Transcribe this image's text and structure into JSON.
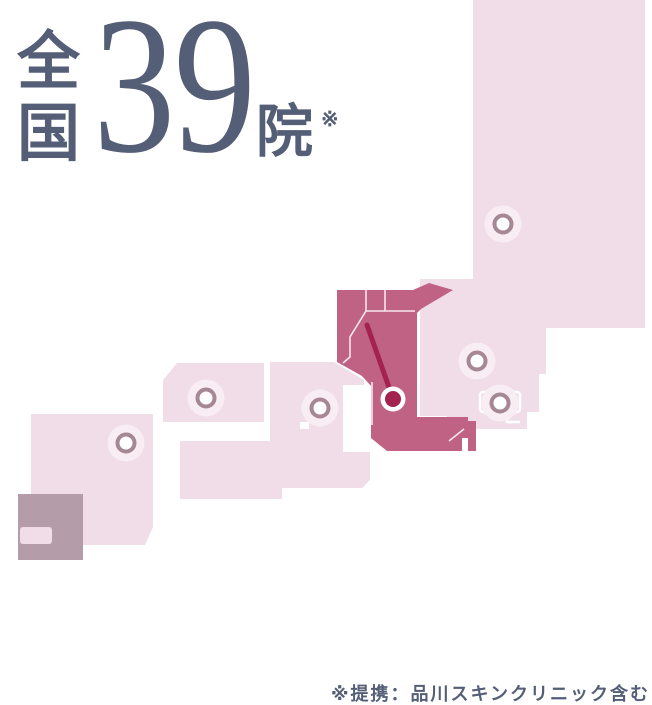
{
  "title": {
    "region_word": "全国",
    "count": "39",
    "unit": "院",
    "asterisk": "※"
  },
  "footnote": "※提携：品川スキンクリニック含む",
  "colors": {
    "ink": "#555e77",
    "pink": "#f1dde7",
    "halo": "#f8edf3",
    "ring": "#a68794",
    "magenta": "#c06284",
    "crimson": "#a3224f",
    "gray": "#b59ca9"
  },
  "map": {
    "regions": [
      {
        "id": "hokkaido",
        "highlighted": false
      },
      {
        "id": "tohoku",
        "highlighted": false
      },
      {
        "id": "kanto-koshinetsu",
        "highlighted": true
      },
      {
        "id": "chubu-kinki",
        "highlighted": false
      },
      {
        "id": "chugoku",
        "highlighted": false
      },
      {
        "id": "shikoku",
        "highlighted": false
      },
      {
        "id": "kyushu",
        "highlighted": false
      },
      {
        "id": "okinawa",
        "highlighted": false
      }
    ],
    "markers": [
      {
        "region": "hokkaido",
        "type": "clinic-dot",
        "x": 503,
        "y": 224
      },
      {
        "region": "tohoku-north",
        "type": "clinic-dot",
        "x": 477,
        "y": 361
      },
      {
        "region": "tohoku-south",
        "type": "clinic-dot",
        "x": 500,
        "y": 403
      },
      {
        "region": "tokyo",
        "type": "highlight-pin",
        "x": 393,
        "y": 399
      },
      {
        "region": "chubu",
        "type": "clinic-dot",
        "x": 320,
        "y": 408
      },
      {
        "region": "kinki",
        "type": "clinic-dot",
        "x": 206,
        "y": 398
      },
      {
        "region": "kyushu",
        "type": "clinic-dot",
        "x": 126,
        "y": 443
      }
    ]
  }
}
